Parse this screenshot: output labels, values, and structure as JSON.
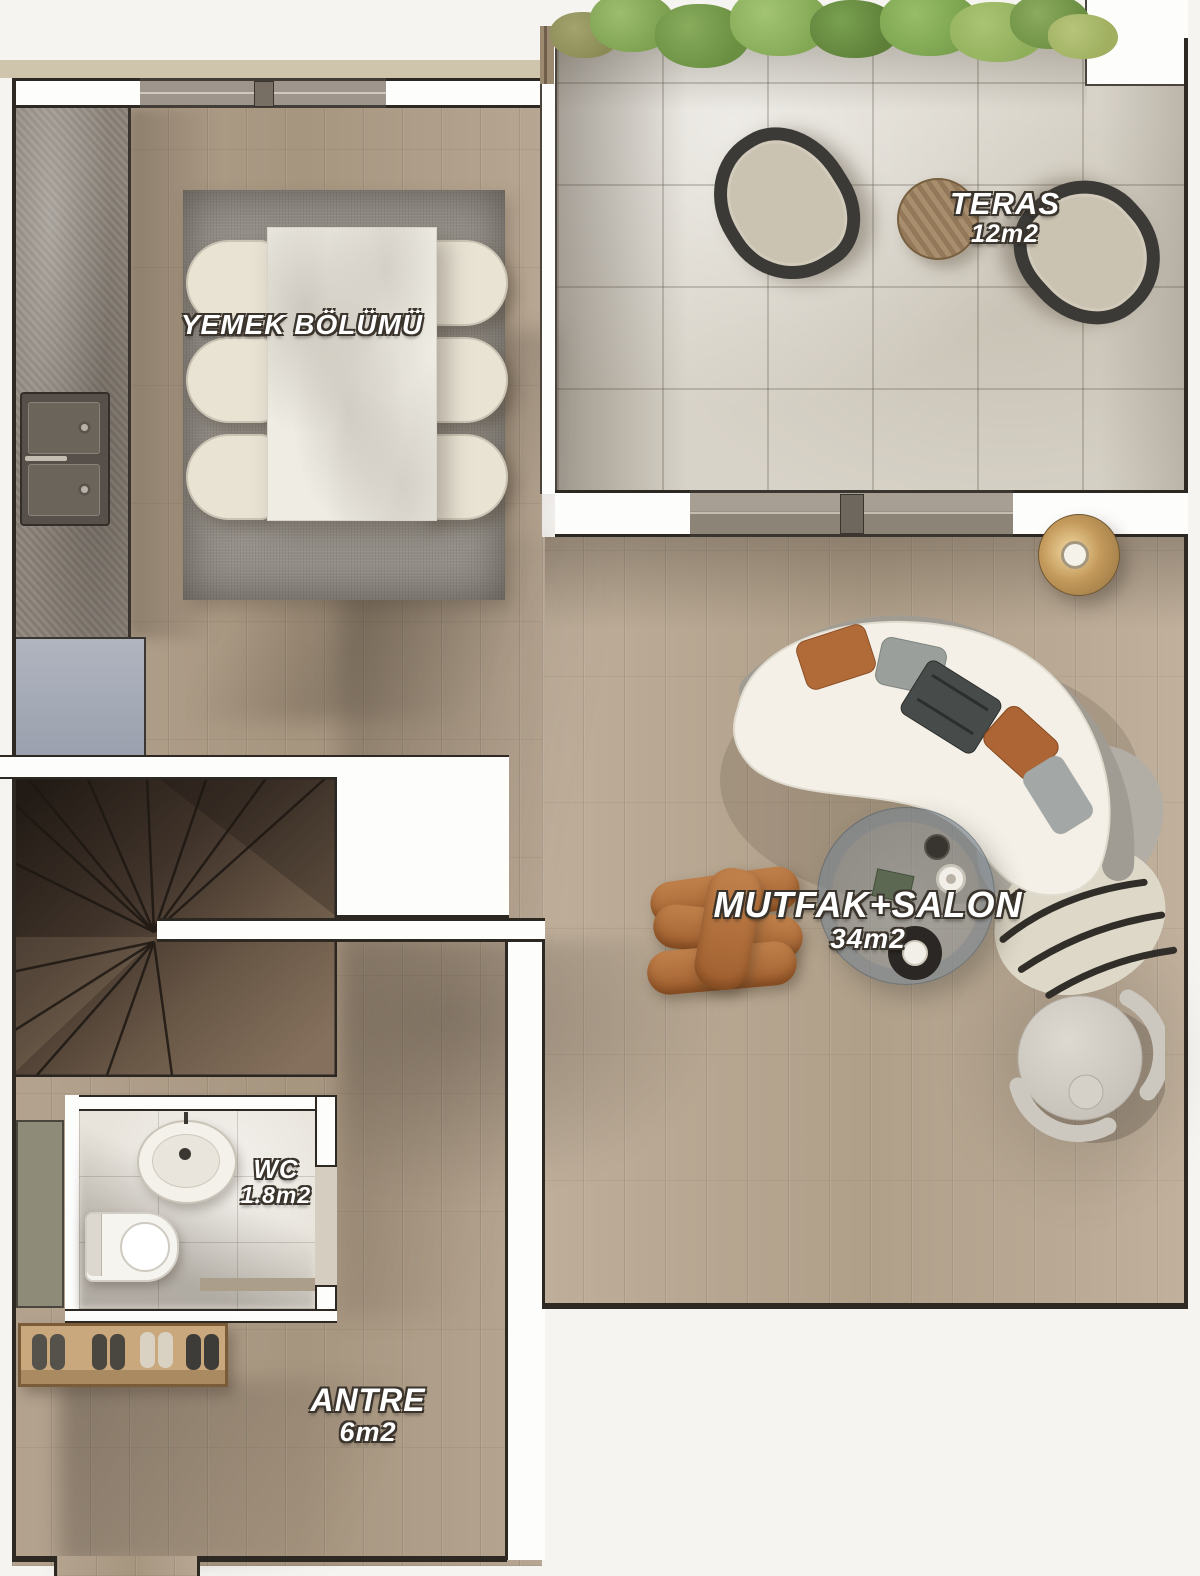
{
  "rooms": {
    "teras": {
      "name": "TERAS",
      "area": "12m2"
    },
    "yemek": {
      "name": "YEMEK BÖLÜMÜ",
      "area": ""
    },
    "salon": {
      "name": "MUTFAK+SALON",
      "area": "34m2"
    },
    "wc": {
      "name": "WC",
      "area": "1.8m2"
    },
    "antre": {
      "name": "ANTRE",
      "area": "6m2"
    }
  },
  "palette": {
    "outside": "#f6f4f1",
    "wall_fill": "#fdfdfc",
    "wall_stroke": "#2e2823",
    "wood_floor": "#b0a08c",
    "terrace_marble": "#d8d3c8",
    "wc_tile": "#e8e4dc",
    "counter_gray": "#8c847a",
    "rug_gray": "#96918a",
    "chair_cream": "#e9e3d4",
    "sofa_seat": "#f4f0e7",
    "sofa_back": "#a09c93",
    "pillow_rust": "#b16b39",
    "pouf_brown": "#b5713d",
    "lamp_gold": "#c49a5c",
    "plant_green": "#6a8f41",
    "stair_wood_dark": "#40332a",
    "shoe_rack_wood": "#c8a87c",
    "label_text": "#ffffff"
  },
  "furniture": [
    "dining-table",
    "dining-chairs-x6",
    "kitchen-counter",
    "kitchen-sink",
    "refrigerator",
    "area-rug",
    "curved-sofa",
    "coffee-table",
    "knot-pouf",
    "round-armchair",
    "floor-lamp",
    "terrace-chairs-x2",
    "terrace-side-table",
    "planter-plants",
    "staircase",
    "wc-sink",
    "toilet",
    "wc-cabinet",
    "shoe-rack",
    "sliding-door",
    "window"
  ]
}
